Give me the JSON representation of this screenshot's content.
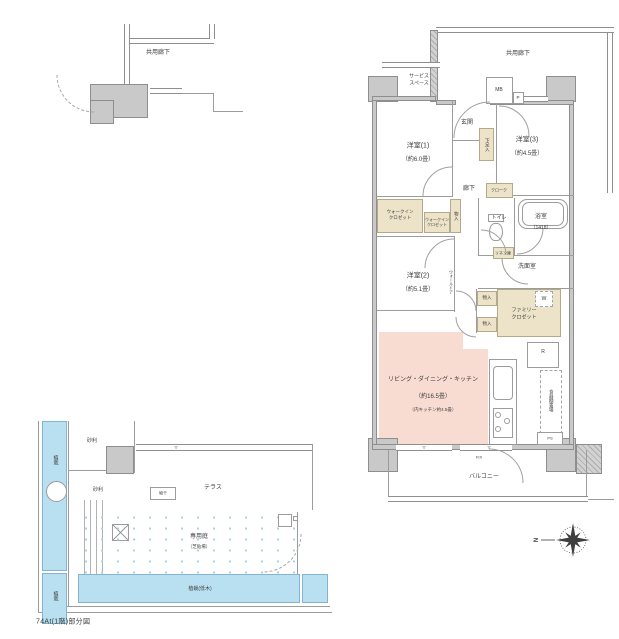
{
  "caption": "74At(1階)部分図",
  "colors": {
    "ldk_pink": "#f8dcd2",
    "closet_beige": "#ece3c9",
    "planting_blue": "#b9e0f1",
    "wall_gray": "#c9c9c9"
  },
  "labels": {
    "corridor_left": "共用廊下",
    "corridor_right": "共用廊下",
    "service_space": "サービス\nスペース",
    "mb": "MB",
    "p": "P",
    "entrance": "玄関",
    "shoe": "下足入",
    "bed1_name": "洋室(1)",
    "bed1_size": "（約6.0畳）",
    "bed2_name": "洋室(2)",
    "bed2_size": "（約5.1畳）",
    "bed3_name": "洋室(3)",
    "bed3_size": "（約4.5畳）",
    "hall": "廊下",
    "cloak": "クローク",
    "wic1": "ウォークイン\nクロゼット",
    "wic2": "ウォークイン\nクロゼット",
    "storage_v": "物入",
    "storage_a": "物入",
    "storage_b": "物入",
    "toilet": "トイレ",
    "bath_name": "浴室",
    "bath_size": "（1418）",
    "linen": "リネン庫",
    "washroom": "洗面室",
    "family_closet": "ファミリー\nクロゼット",
    "washer": "W",
    "fridge": "R",
    "cupboard": "食器棚置場",
    "ps": "PS",
    "wall_door": "ウォールドア",
    "ldk_name": "リビング・ダイニング・キッチン",
    "ldk_size": "（約16.5畳）",
    "ldk_note": "（内キッチン約4.5畳）",
    "fix": "FIX",
    "tri": "▽",
    "balcony": "バルコニー",
    "terrace": "テラス",
    "garden_name": "専用庭",
    "garden_note": "（芝貼場）",
    "planting_low": "植栽(低木)",
    "planting_left_top": "植栽",
    "planting_left_bottom": "植栽",
    "gravel1": "砂利",
    "gravel2": "砂利",
    "drying": "物干",
    "north": "N"
  }
}
